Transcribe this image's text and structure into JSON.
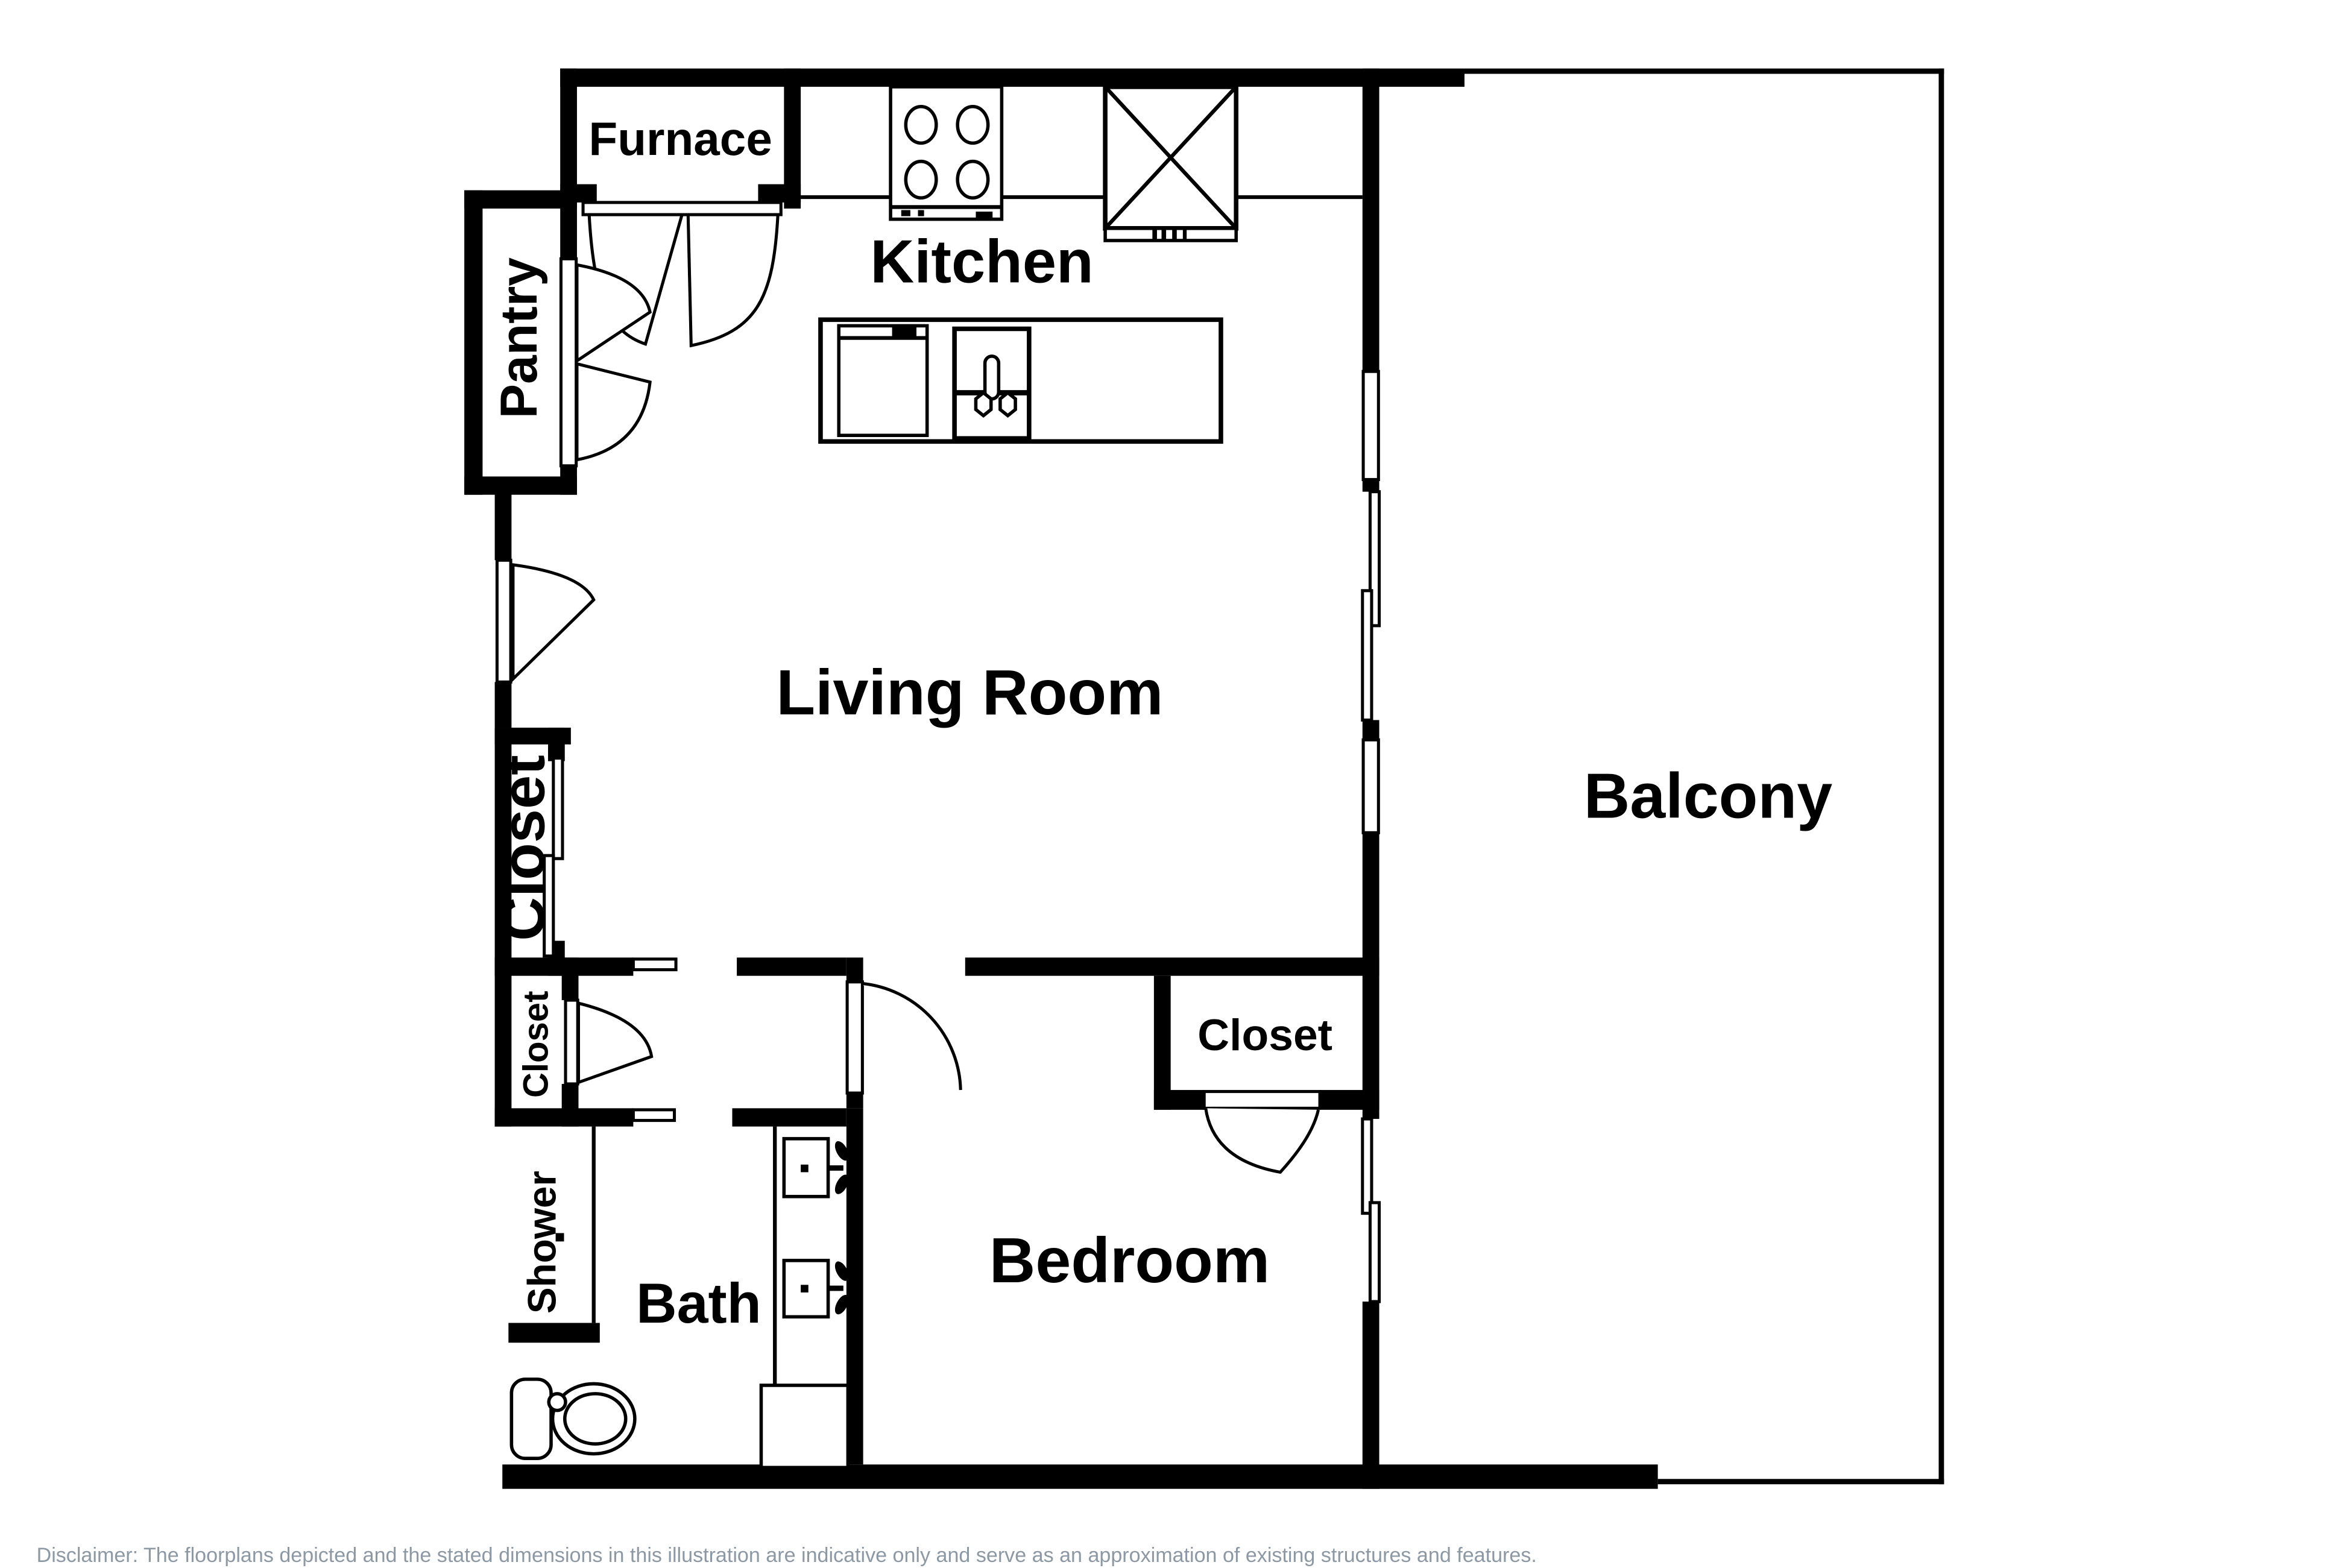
{
  "title": "Floor plan",
  "rooms": {
    "furnace": {
      "label": "Furnace"
    },
    "kitchen": {
      "label": "Kitchen"
    },
    "pantry": {
      "label": "Pantry"
    },
    "living_room": {
      "label": "Living Room"
    },
    "balcony": {
      "label": "Balcony"
    },
    "closet_hall_large": {
      "label": "Closet"
    },
    "closet_hall_small": {
      "label": "Closet"
    },
    "shower": {
      "label": "Shower"
    },
    "bath": {
      "label": "Bath"
    },
    "bedroom": {
      "label": "Bedroom"
    },
    "closet_bedroom": {
      "label": "Closet"
    }
  },
  "footer": {
    "disclaimer": "Disclaimer: The floorplans depicted and the stated dimensions in this illustration are indicative only and serve as an approximation of existing structures and features."
  },
  "colors": {
    "walls": "#000000",
    "background": "#ffffff",
    "disclaimer_text": "#8C98A4"
  },
  "icons": [
    "stove-icon",
    "fridge-icon",
    "island-counter",
    "dishwasher-icon",
    "kitchen-sink-icon",
    "toilet-icon",
    "vanity-sink-icon",
    "shower-stall",
    "door-swing-icon",
    "bifold-door-icon",
    "sliding-door-icon",
    "window-icon"
  ]
}
